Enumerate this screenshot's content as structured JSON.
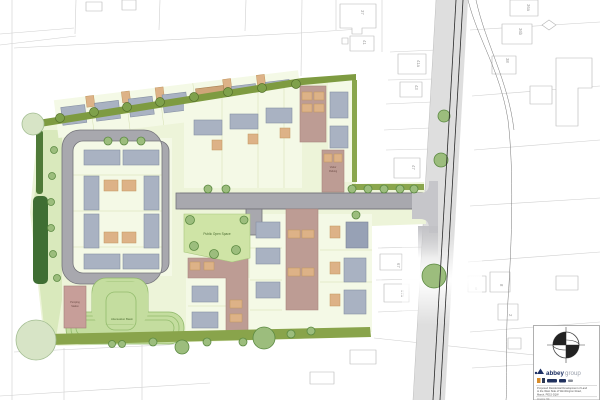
{
  "drawing": {
    "kind": "Residential development site layout plan",
    "labels": {
      "public_open_space": "Public Open Space",
      "attenuation_basin": "Attenuation Basin",
      "pumping_line1": "Pumping",
      "pumping_line2": "Station",
      "visitor_line1": "Visitor",
      "visitor_line2": "Parking"
    },
    "existing_plots": {
      "n37": "37",
      "n41": "41",
      "n41a": "41a",
      "n43": "43",
      "n47": "47",
      "n67": "67",
      "n67a": "67a",
      "n36a": "36a",
      "n36b": "36b",
      "n38": "38",
      "n6": "6",
      "n8": "8",
      "n2": "2"
    }
  },
  "title_block": {
    "logo_bold": "abbey",
    "logo_light": "group",
    "project_line1": "Proposed Residential Development of Land",
    "project_line2": "to the West Side of Wimblington Road,",
    "project_line3": "March, PE15 0QW",
    "drawing_label": "Drawing Title",
    "drawing_title": "Site Layout Plan",
    "scale_text": "Scale 1:500 @ A1"
  },
  "colors": {
    "estate_road": "#a8a8ae",
    "main_road": "#dedede",
    "site_base": "#edf4d9",
    "plot": "#f4f9e6",
    "hedge": "#7e9b41",
    "verge": "#d9e9bc",
    "open_space": "#cfe4a6",
    "basin": "#c4dd9f",
    "roof": "#a9b2c2",
    "driveway": "#ddb287",
    "parking_court": "#bd9c94",
    "tree": "#9cbd7d",
    "logo_navy": "#1c2f63"
  }
}
